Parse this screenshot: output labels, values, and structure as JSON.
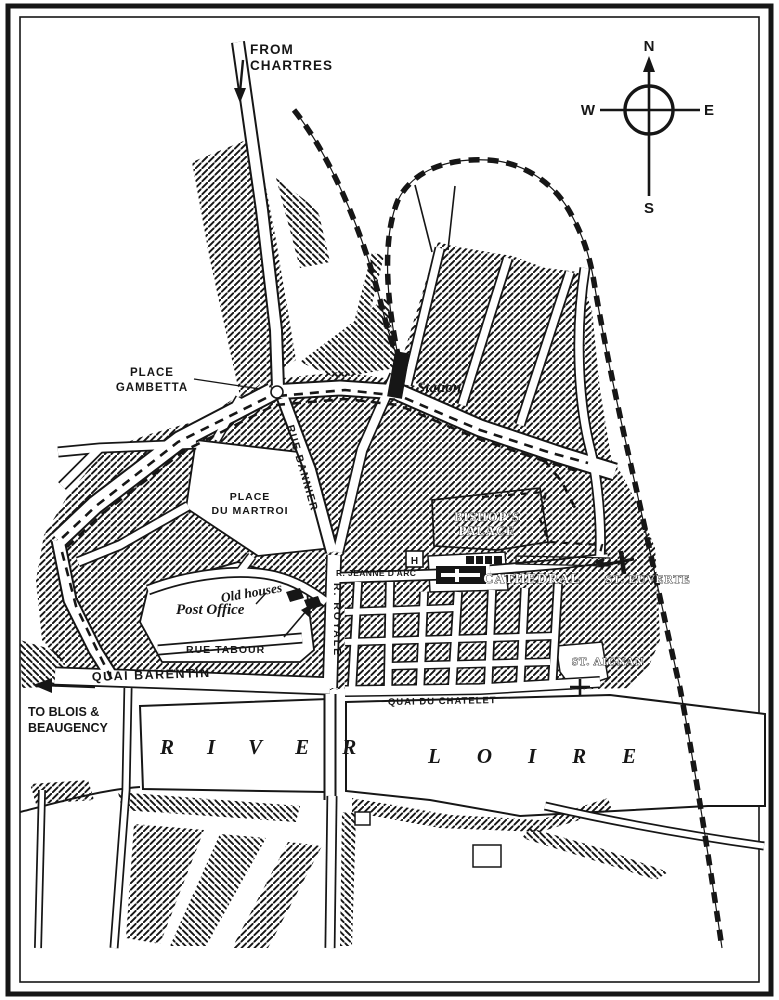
{
  "colors": {
    "ink": "#161616",
    "paper": "#ffffff"
  },
  "compass": {
    "north": "N",
    "south": "S",
    "east": "E",
    "west": "W"
  },
  "labels": {
    "from_chartres": [
      "FROM",
      "CHARTRES"
    ],
    "place_gambetta": [
      "PLACE",
      "GAMBETTA"
    ],
    "station": "Station",
    "rue_bannier": "RUE BANNIER",
    "place_du_martroi": [
      "PLACE",
      "DU MARTROI"
    ],
    "bishops_palace": [
      "BISHOP'S",
      "PALACE"
    ],
    "cathedral": "CATHEDRAL",
    "st_euverte": "ST. EUVERTE",
    "rue_jeanne_darc": "R. JEANNE D'ARC",
    "old_houses": "Old houses",
    "post_office": "Post Office",
    "rue_tabour": "RUE TABOUR",
    "rue_royale": "R. ROYALE",
    "quai_barentin": "QUAI BARENTIN",
    "to_blois": [
      "TO BLOIS &",
      "BEAUGENCY"
    ],
    "quai_du_chatelet": "QUAI DU CHATELET",
    "st_aignan": "ST. AIGNAN",
    "river": "RIVER",
    "loire": "LOIRE",
    "hotel_h": "H"
  },
  "icons": {
    "compass_rose": "compass-rose",
    "north_arrow": "north-arrow",
    "station_block": "station-building-block",
    "cathedral_block": "cathedral-building-symbol",
    "st_euverte_mark": "church-cross-symbol",
    "st_aignan_mark": "church-cross-symbol",
    "old_houses_mark": "old-houses-black-blocks",
    "railway_line": "dashed-railway-line",
    "tram_line": "dashed-tramway-line",
    "road_arrow_chartres": "direction-arrow-down",
    "road_arrow_blois": "direction-arrow-left"
  }
}
